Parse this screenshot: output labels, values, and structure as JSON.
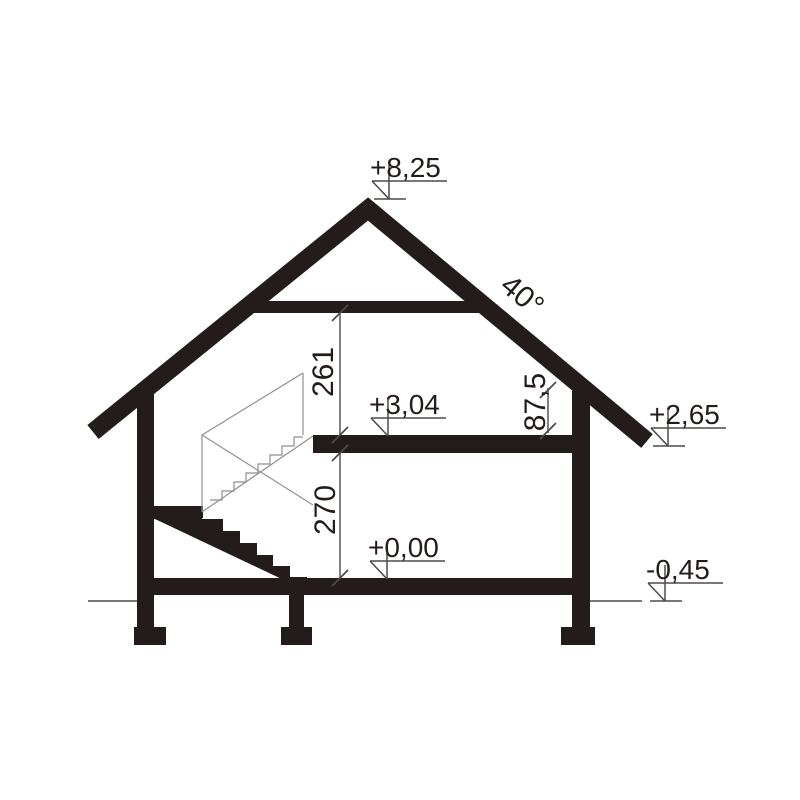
{
  "levels": {
    "ridge": "+8,25",
    "first_floor": "+3,04",
    "eaves": "+2,65",
    "ground_floor": "+0,00",
    "terrain": "-0,45"
  },
  "dimensions": {
    "attic_room_height": "261",
    "ground_floor_height": "270",
    "knee_wall_height": "87,5",
    "roof_pitch": "40°"
  },
  "colors": {
    "ink": "#241c1a",
    "dimension_line": "#4e4a48",
    "projection_line": "#8f8f8f",
    "background": "#ffffff"
  }
}
